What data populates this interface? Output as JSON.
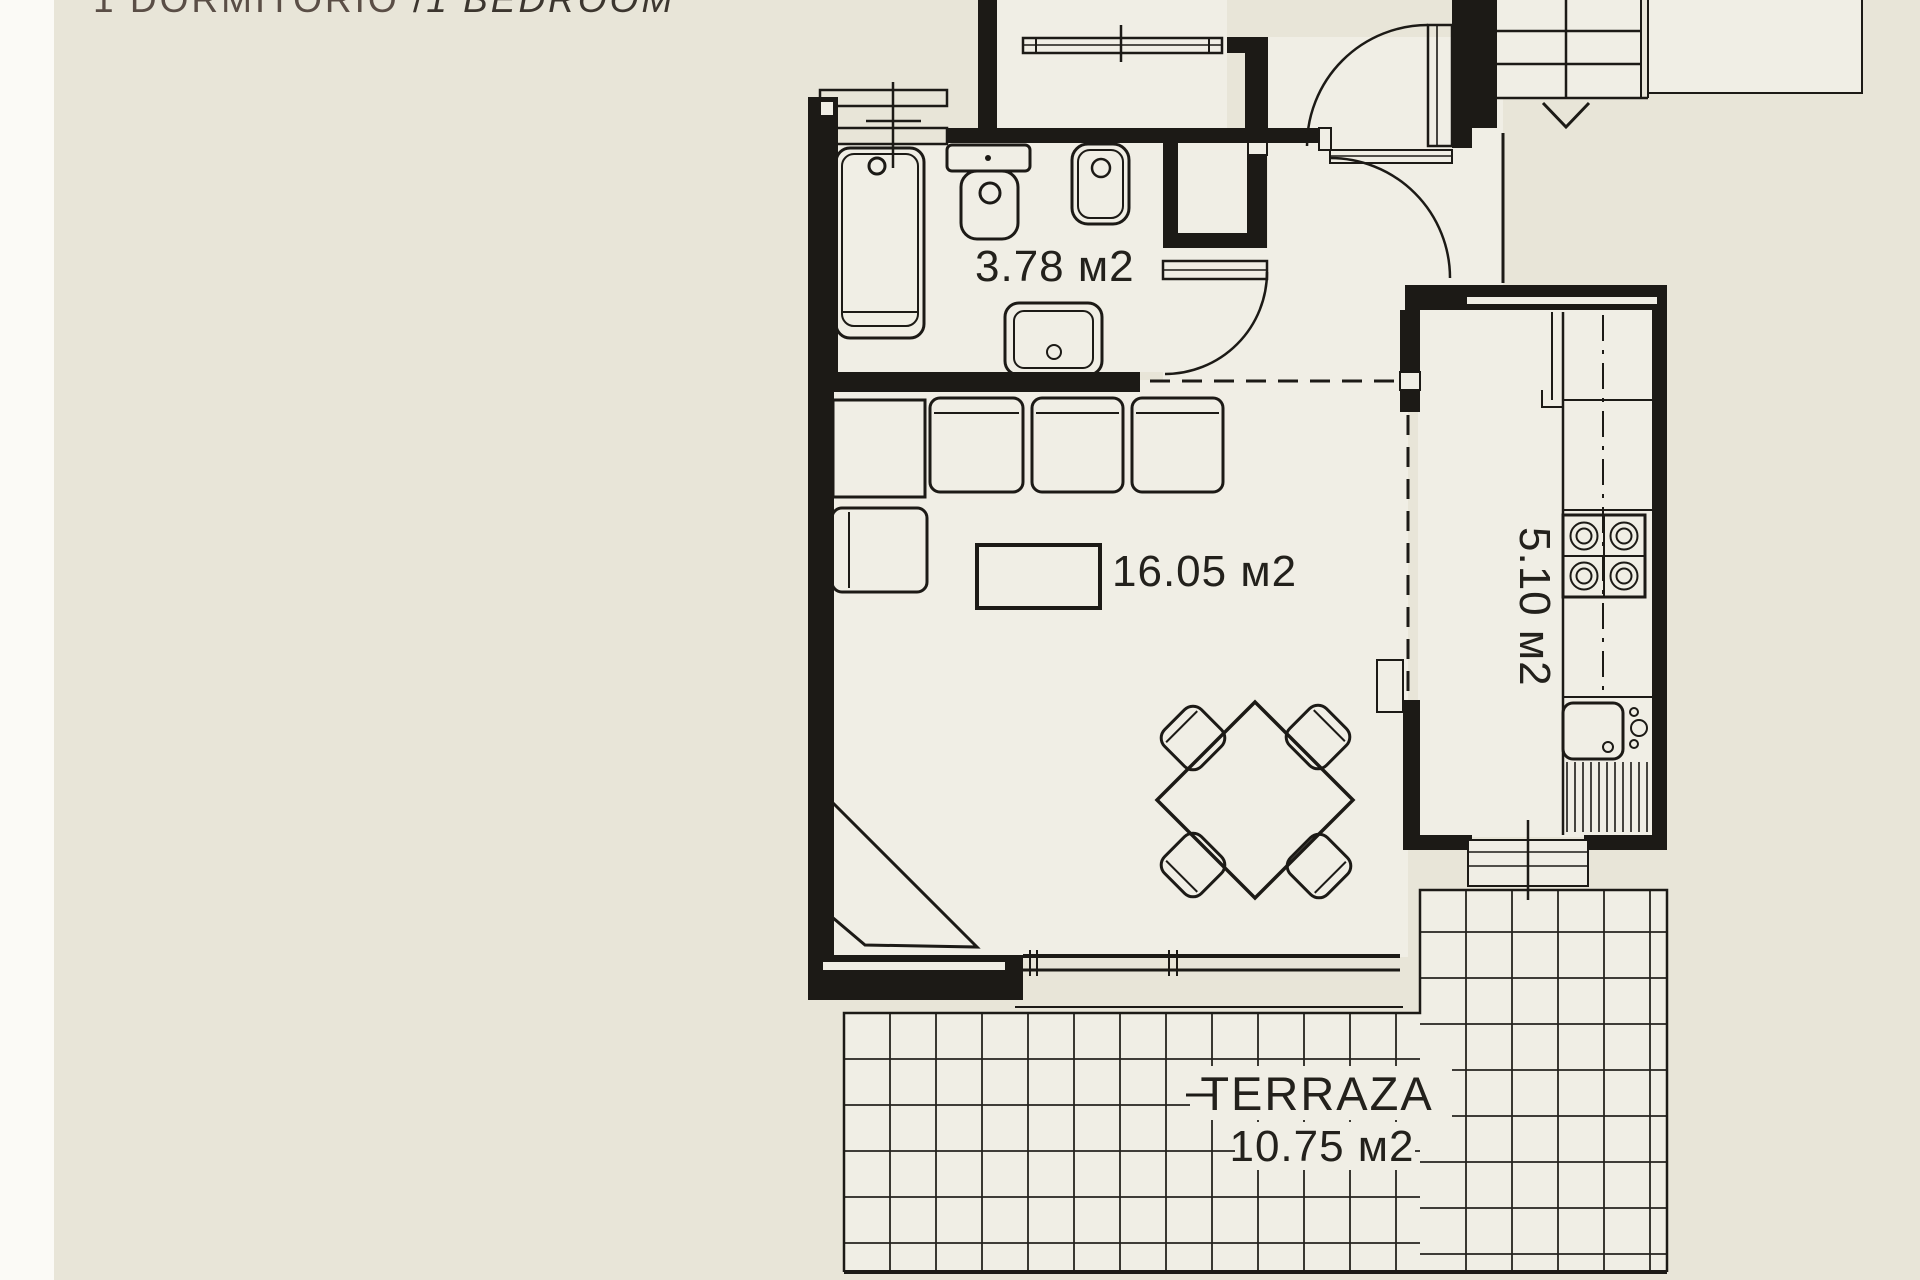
{
  "title": {
    "es": "1 DORMITORIO",
    "sep": " /",
    "en": "1 BEDROOM"
  },
  "rooms": {
    "bathroom": {
      "area_label": "3.78 м2"
    },
    "living": {
      "area_label": "16.05 м2"
    },
    "kitchen": {
      "area_label": "5.10 м2"
    },
    "terrace": {
      "name": "TERRAZA",
      "area_label": "10.75 м2"
    }
  },
  "colors": {
    "background": "#e8e5d8",
    "floor": "#f0eee5",
    "wall": "#1c1a16",
    "title_primary": "#5a4e46",
    "title_secondary": "#3c362f",
    "label_text": "#23211c"
  },
  "icons": {
    "stair_direction_arrow": "down-arrow"
  }
}
